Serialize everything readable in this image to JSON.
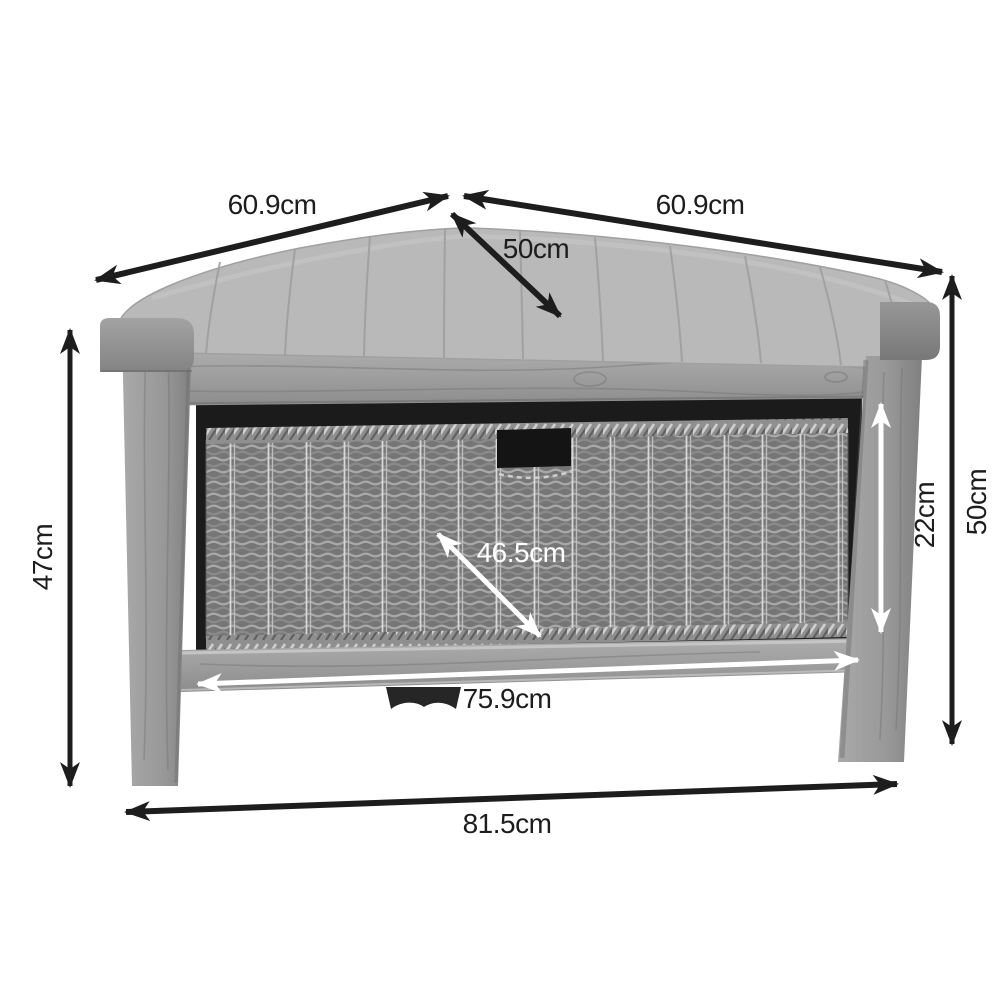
{
  "diagram": {
    "type": "product-dimension-diagram",
    "subject": "corner storage bench with wicker drawer and cushion seat",
    "unit": "cm",
    "labels": {
      "top_left_width": "60.9cm",
      "top_right_width": "60.9cm",
      "seat_depth": "50cm",
      "left_height": "47cm",
      "overall_height": "50cm",
      "drawer_height": "22cm",
      "drawer_diagonal": "46.5cm",
      "inner_width": "75.9cm",
      "overall_width": "81.5cm"
    },
    "colors": {
      "background": "#ffffff",
      "dimension_line_dark": "#1d1d1d",
      "dimension_line_light": "#ffffff",
      "label_dark": "#1d1d1d",
      "label_light": "#ffffff",
      "cushion": "#b9b9b9",
      "wood": "#9c9c9c",
      "interior": "#1b1b1b",
      "handle": "#141414",
      "basket": "#787878",
      "foot": "#262626"
    }
  }
}
